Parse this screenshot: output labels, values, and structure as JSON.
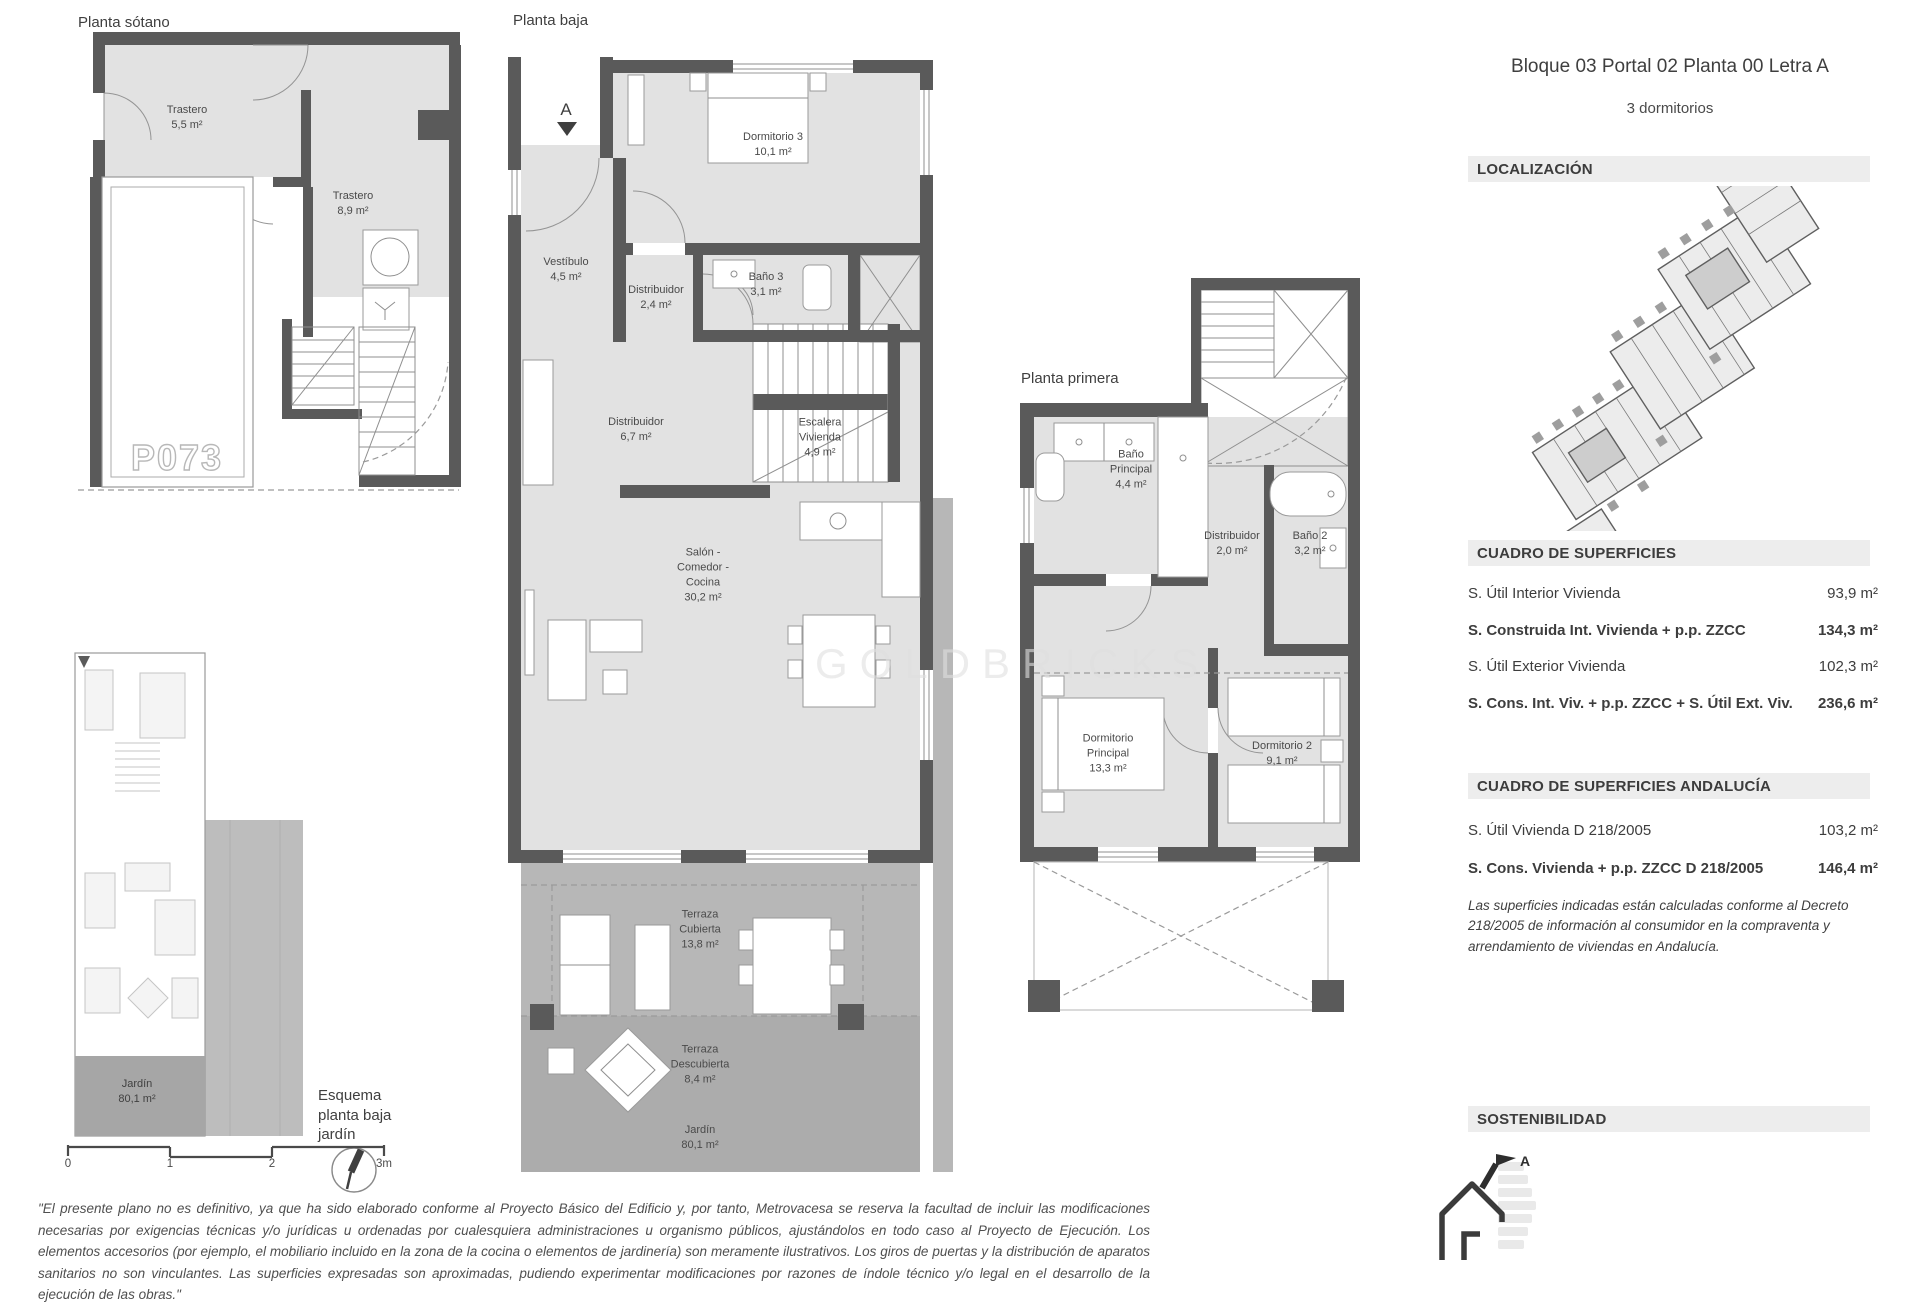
{
  "header": {
    "title": "Bloque 03 Portal 02 Planta 00 Letra A",
    "subtitle": "3 dormitorios"
  },
  "sections": {
    "localizacion": "LOCALIZACIÓN",
    "superficies": "CUADRO DE SUPERFICIES",
    "andalucia": "CUADRO DE SUPERFICIES ANDALUCÍA",
    "sostenibilidad": "SOSTENIBILIDAD"
  },
  "superficies": {
    "rows": [
      {
        "label": "S. Útil Interior Vivienda",
        "value": "93,9 m²"
      },
      {
        "label": "S. Construida Int. Vivienda + p.p. ZZCC",
        "value": "134,3 m²"
      },
      {
        "label": "S. Útil Exterior Vivienda",
        "value": "102,3 m²"
      },
      {
        "label": "S. Cons. Int. Viv. + p.p. ZZCC + S. Útil Ext. Viv.",
        "value": "236,6 m²"
      }
    ]
  },
  "andalucia": {
    "rows": [
      {
        "label": "S. Útil Vivienda D 218/2005",
        "value": "103,2 m²"
      },
      {
        "label": "S. Cons. Vivienda + p.p. ZZCC D 218/2005",
        "value": "146,4 m²"
      }
    ],
    "note": "Las superficies indicadas están calculadas conforme al Decreto 218/2005 de información al consumidor en la compraventa y arrendamiento de viviendas en Andalucía."
  },
  "plans": {
    "sotano": {
      "title": "Planta sótano",
      "parking": "P073",
      "rooms": {
        "trastero1": {
          "name": "Trastero",
          "area": "5,5 m²"
        },
        "trastero2": {
          "name": "Trastero",
          "area": "8,9 m²"
        }
      }
    },
    "baja": {
      "title": "Planta baja",
      "marker": "A",
      "rooms": {
        "dormitorio3": {
          "name": "Dormitorio 3",
          "area": "10,1 m²"
        },
        "vestibulo": {
          "name": "Vestíbulo",
          "area": "4,5 m²"
        },
        "distribuidor_a": {
          "name": "Distribuidor",
          "area": "2,4 m²"
        },
        "bano3": {
          "name": "Baño 3",
          "area": "3,1 m²"
        },
        "distribuidor_b": {
          "name": "Distribuidor",
          "area": "6,7 m²"
        },
        "escalera": {
          "name": "Escalera Vivienda",
          "area": "4,9 m²"
        },
        "salon": {
          "name": "Salón - Comedor - Cocina",
          "area": "30,2 m²"
        },
        "terraza_cubierta": {
          "name": "Terraza Cubierta",
          "area": "13,8 m²"
        },
        "terraza_descubierta": {
          "name": "Terraza Descubierta",
          "area": "8,4 m²"
        },
        "jardin": {
          "name": "Jardín",
          "area": "80,1 m²"
        }
      }
    },
    "primera": {
      "title": "Planta primera",
      "rooms": {
        "bano_principal": {
          "name": "Baño Principal",
          "area": "4,4 m²"
        },
        "distribuidor": {
          "name": "Distribuidor",
          "area": "2,0 m²"
        },
        "bano2": {
          "name": "Baño 2",
          "area": "3,2 m²"
        },
        "dormitorio_principal": {
          "name": "Dormitorio Principal",
          "area": "13,3 m²"
        },
        "dormitorio2": {
          "name": "Dormitorio 2",
          "area": "9,1 m²"
        }
      }
    },
    "esquema": {
      "caption": "Esquema\nplanta baja\njardín",
      "jardin": {
        "name": "Jardín",
        "area": "80,1 m²"
      }
    }
  },
  "scalebar": {
    "labels": [
      "0",
      "1",
      "2",
      "3m"
    ]
  },
  "energy": {
    "rating": "A"
  },
  "watermark": "GOLDBRICKS",
  "disclaimer": "\"El presente plano no es definitivo, ya que ha sido elaborado conforme al Proyecto Básico del Edificio y, por tanto, Metrovacesa se reserva la facultad de incluir las modificaciones necesarias por exigencias técnicas y/o jurídicas u ordenadas por cualesquiera administraciones u organismo públicos, ajustándolos en todo caso al Proyecto de Ejecución. Los elementos accesorios (por ejemplo, el mobiliario incluido en la zona de la cocina o elementos de jardinería) son meramente ilustrativos. Los giros de puertas y la distribución de aparatos sanitarios no son vinculantes. Las superficies expresadas son aproximadas, pudiendo experimentar modificaciones por razones de índole técnico y/o legal en el desarrollo de la ejecución de las obras.\""
}
